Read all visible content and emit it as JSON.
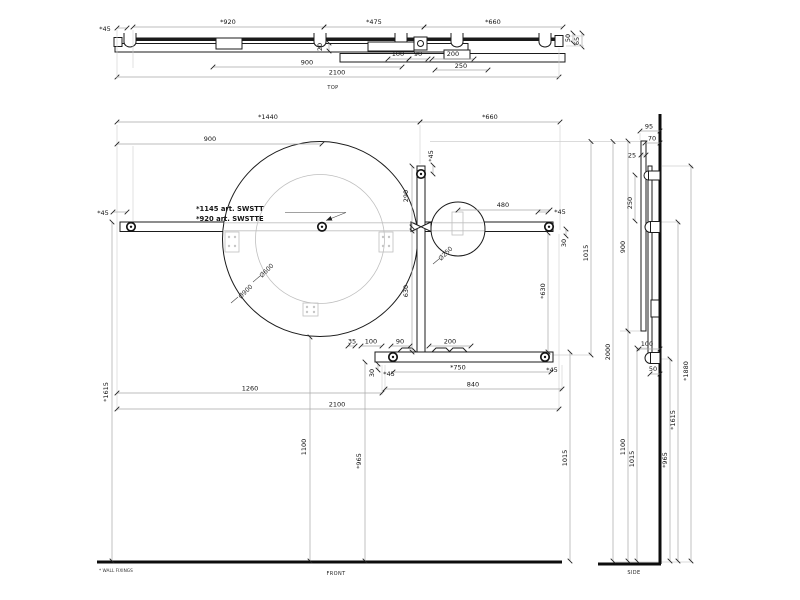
{
  "drawing": {
    "product": {
      "art_line1": "*1145 art. SWSTT",
      "art_line2": "*920 art. SWSTTE"
    },
    "footnote": "* WALL FIXINGS",
    "views": {
      "top": {
        "label": "TOP",
        "dims": {
          "d45": "*45",
          "d920": "*920",
          "d475": "*475",
          "d660": "*660",
          "d20": "20",
          "d100": "100",
          "d90": "90",
          "d200": "200",
          "d250": "250",
          "d900": "900",
          "d2100": "2100",
          "d50": "50",
          "d65": "65"
        }
      },
      "front": {
        "label": "FRONT",
        "dims": {
          "d1440": "*1440",
          "d660": "*660",
          "d900": "900",
          "d45": "*45",
          "d290": "290",
          "d480": "480",
          "d30": "30",
          "d630": "630",
          "d630s": "*630",
          "d1015": "1015",
          "d35": "35",
          "d100": "100",
          "d90": "90",
          "d200": "200",
          "d750": "*750",
          "d840": "840",
          "d1260": "1260",
          "d2100": "2100",
          "d1615": "*1615",
          "d1100": "1100",
          "d965": "*965"
        },
        "diameters": {
          "big": "Ø900",
          "inner": "Ø600",
          "small": "Ø250"
        }
      },
      "side": {
        "label": "SIDE",
        "dims": {
          "d95": "95",
          "d70": "70",
          "d25": "25",
          "d250": "250",
          "d900": "900",
          "d2000": "2000",
          "d100": "100",
          "d50": "50",
          "d1880": "*1880",
          "d1615": "*1615",
          "d1100": "1100",
          "d1015": "1015",
          "d965": "*965"
        }
      }
    }
  }
}
